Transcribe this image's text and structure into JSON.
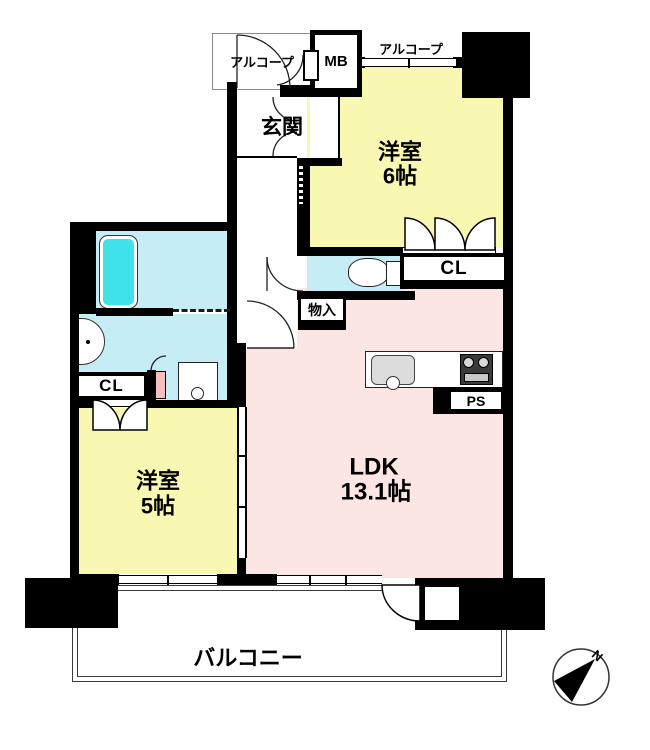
{
  "labels": {
    "alcove_left": "アルコープ",
    "alcove_right": "アルコープ",
    "meter_box": "MB",
    "entrance": "玄関",
    "bedroom6_name": "洋室",
    "bedroom6_size": "6帖",
    "closet_right": "CL",
    "storage": "物入",
    "closet_left": "CL",
    "bedroom5_name": "洋室",
    "bedroom5_size": "5帖",
    "ldk_name": "LDK",
    "ldk_size": "13.1帖",
    "pipe_space": "PS",
    "balcony": "バルコニー",
    "compass_north": "N"
  },
  "colors": {
    "wall": "#000000",
    "bedroom": "#f9f8b2",
    "ldk": "#fce6e4",
    "wet_area": "#c6edf5",
    "bathtub": "#3fe2e9",
    "heater": "#f5bfc0"
  }
}
